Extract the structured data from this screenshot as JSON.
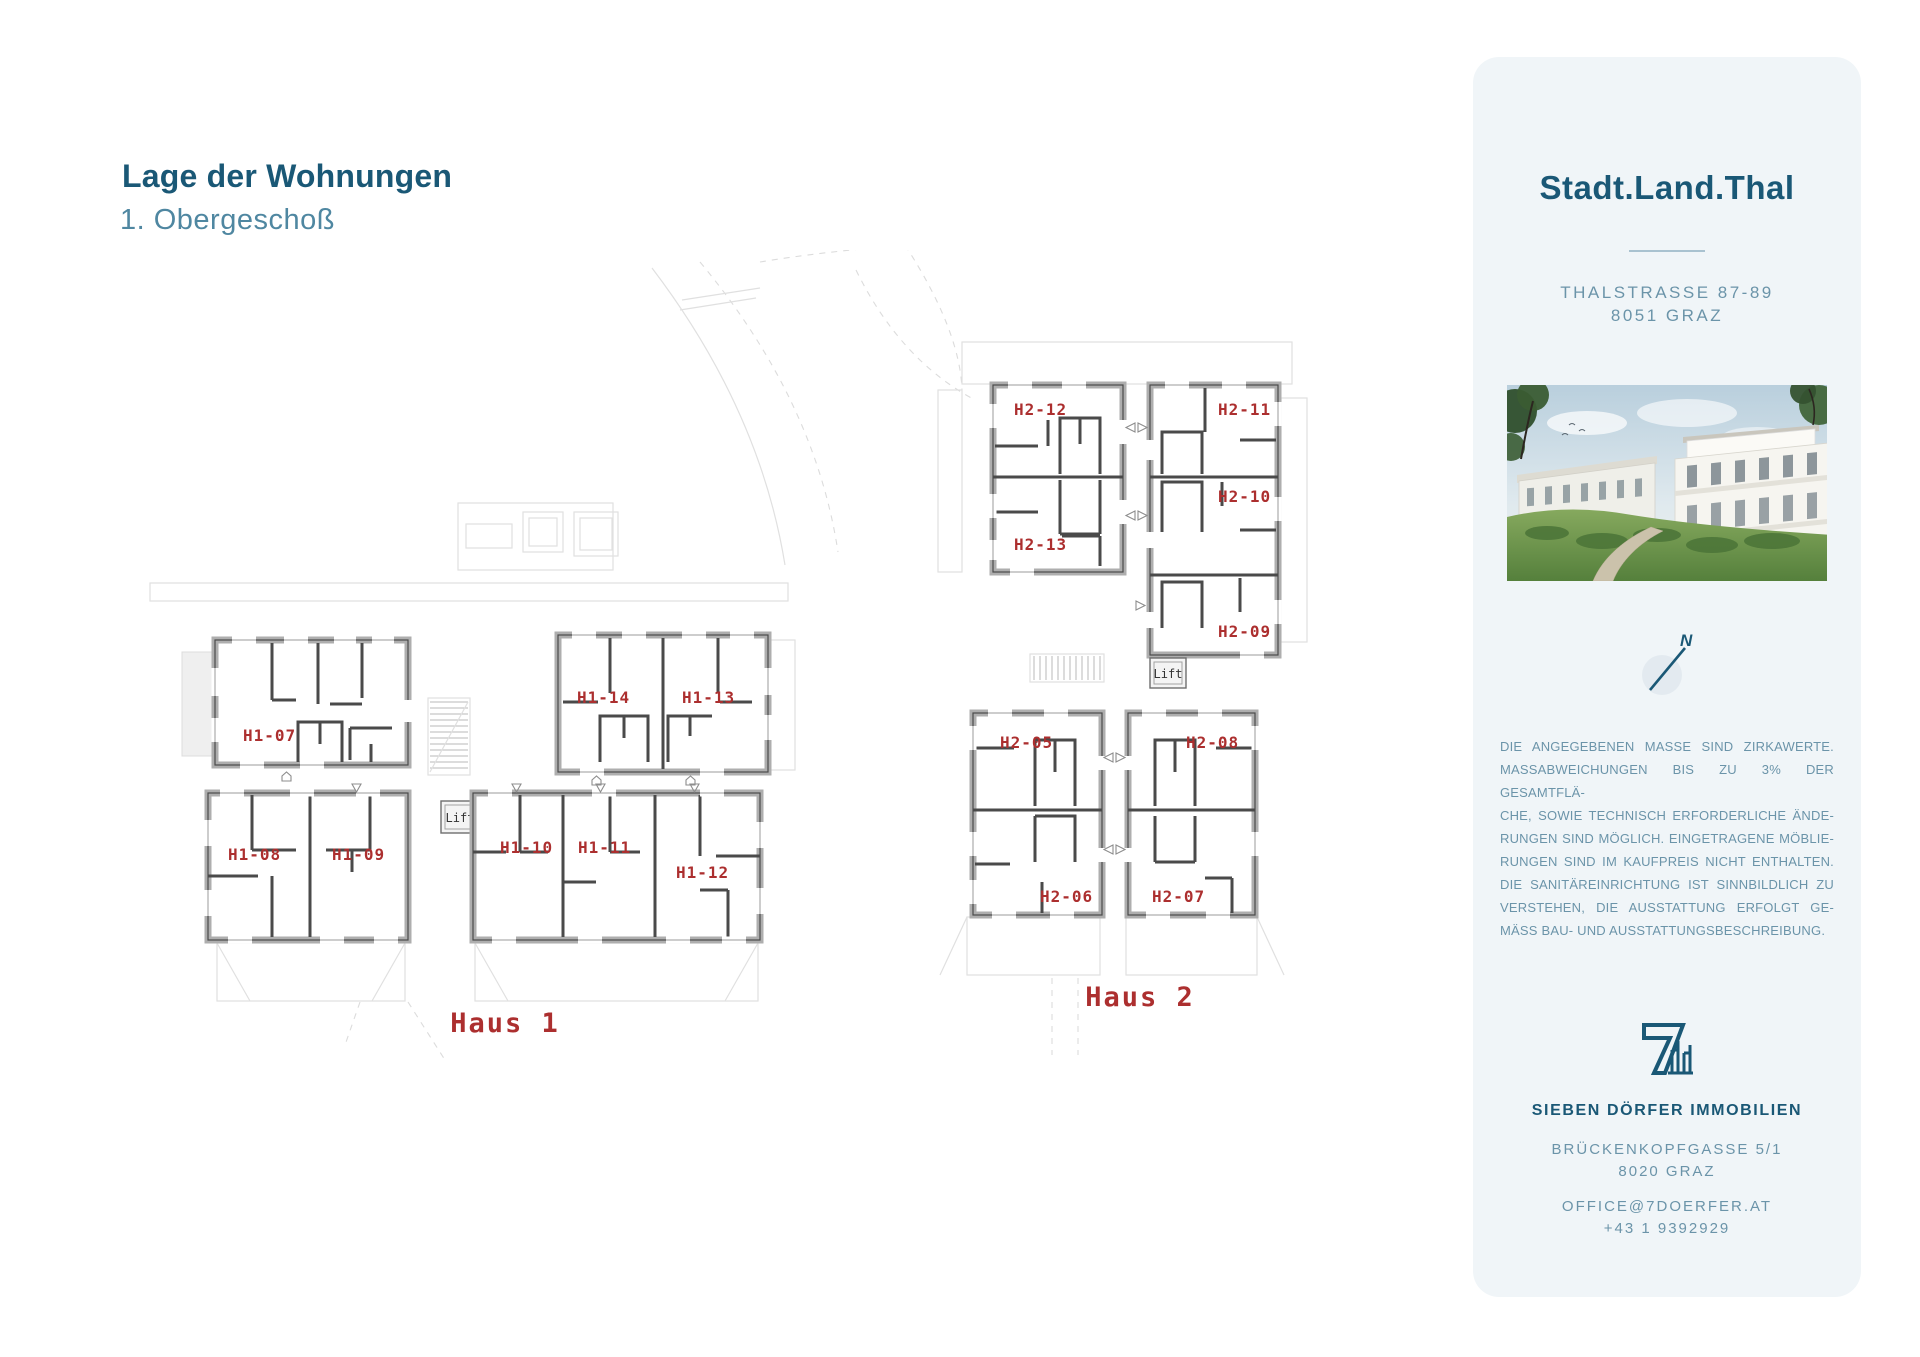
{
  "page": {
    "title": "Lage der Wohnungen",
    "subtitle": "1. Obergeschoß"
  },
  "plan": {
    "lift_label": "Lift",
    "north_label": "N",
    "haus1": {
      "label": "Haus 1",
      "units": [
        "H1-07",
        "H1-14",
        "H1-13",
        "H1-08",
        "H1-09",
        "H1-10",
        "H1-11",
        "H1-12"
      ]
    },
    "haus2": {
      "label": "Haus 2",
      "units": [
        "H2-12",
        "H2-11",
        "H2-13",
        "H2-10",
        "H2-09",
        "H2-05",
        "H2-08",
        "H2-06",
        "H2-07"
      ]
    }
  },
  "sidebar": {
    "brand": "Stadt.Land.Thal",
    "address_line1": "THALSTRASSE 87-89",
    "address_line2": "8051 GRAZ",
    "disclaimer_lines": [
      "DIE ANGEGEBENEN MASSE SIND ZIRKAWERTE.",
      "MASSABWEICHUNGEN BIS ZU 3% DER GESAMTFLÄ-",
      "CHE, SOWIE TECHNISCH ERFORDERLICHE ÄNDE-",
      "RUNGEN SIND MÖGLICH. EINGETRAGENE MÖBLIE-",
      "RUNGEN SIND IM KAUFPREIS NICHT ENTHALTEN.",
      "DIE SANITÄREINRICHTUNG IST SINNBILDLICH ZU",
      "VERSTEHEN, DIE AUSSTATTUNG ERFOLGT GE-",
      "MÄSS BAU- UND AUSSTATTUNGSBESCHREIBUNG."
    ],
    "company": "SIEBEN DÖRFER IMMOBILIEN",
    "company_address_line1": "BRÜCKENKOPFGASSE 5/1",
    "company_address_line2": "8020 GRAZ",
    "email": "OFFICE@7DOERFER.AT",
    "phone": "+43 1 9392929"
  },
  "colors": {
    "accent": "#1A5876",
    "subtitle": "#4F87A1",
    "muted": "#6B94A9",
    "unit_label": "#AC2F2F",
    "panel_bg": "#F0F5F8",
    "wall": "#4A4A4A"
  }
}
